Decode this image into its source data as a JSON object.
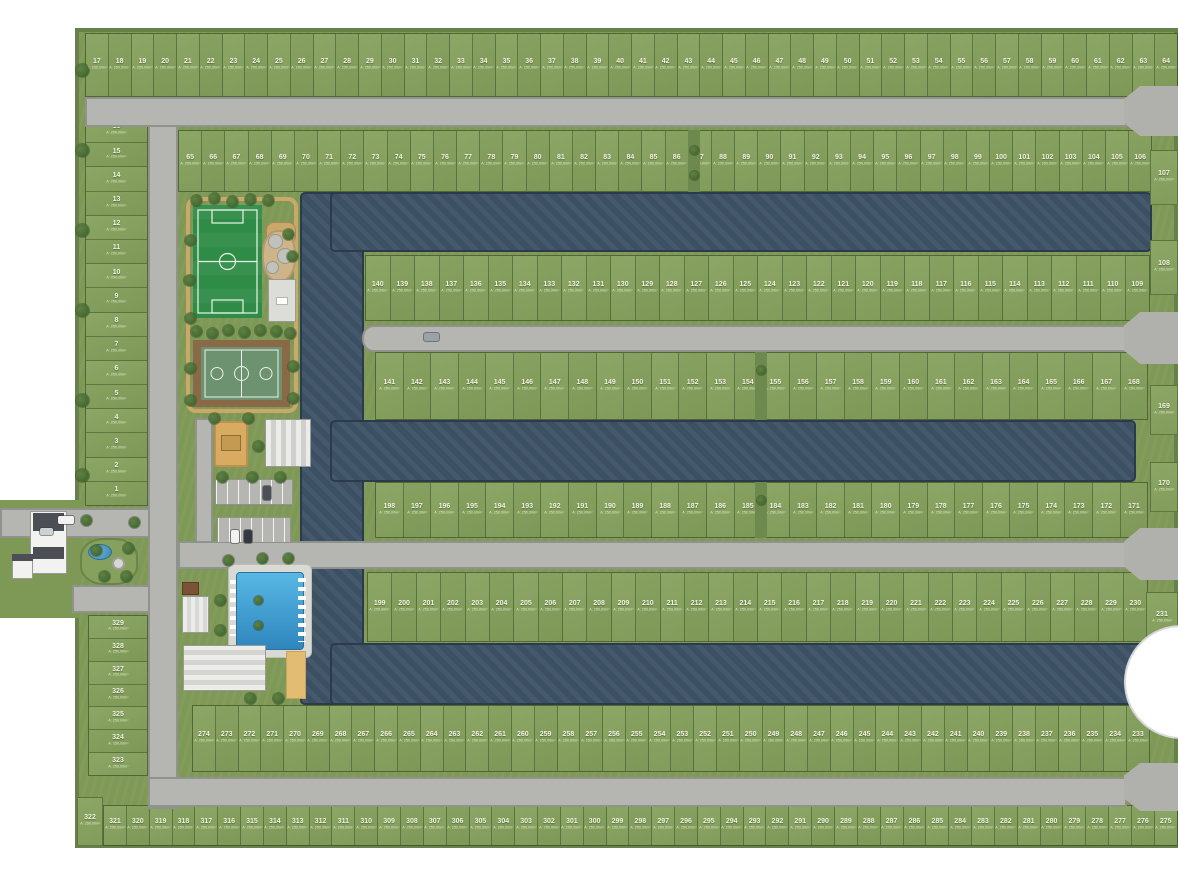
{
  "map_type": "residential-masterplan-site-map",
  "area_label": "A: 250,00m²",
  "colors": {
    "grass": "#7e9856",
    "lot_green": "#8ca765",
    "road_gray": "#b5b6b2",
    "water_blue": "#3c5064",
    "pool_blue": "#3f9fd1",
    "sand_tan": "#d8ab60",
    "soccer_field_green": "#2f8c46",
    "court_green": "#6d9270",
    "path_tan": "#c9a86a",
    "building_white": "#ececea",
    "roof_dark": "#4b4f55"
  },
  "lot_rows": [
    {
      "id": "left-column-top",
      "dir": "v",
      "rect": [
        85,
        118,
        63,
        388
      ],
      "from": 16,
      "to": 1
    },
    {
      "id": "top-row",
      "dir": "h",
      "rect": [
        85,
        33,
        1093,
        64
      ],
      "from": 17,
      "to": 64
    },
    {
      "id": "row-65-106",
      "dir": "h",
      "rect": [
        178,
        130,
        974,
        62
      ],
      "from": 65,
      "to": 106
    },
    {
      "id": "row-140-109",
      "dir": "h",
      "rect": [
        365,
        255,
        785,
        66
      ],
      "from": 140,
      "to": 109
    },
    {
      "id": "row-141-168",
      "dir": "h",
      "rect": [
        375,
        352,
        773,
        68
      ],
      "from": 141,
      "to": 168
    },
    {
      "id": "row-198-171",
      "dir": "h",
      "rect": [
        375,
        482,
        773,
        56
      ],
      "from": 198,
      "to": 171
    },
    {
      "id": "row-199-230",
      "dir": "h",
      "rect": [
        367,
        572,
        781,
        70
      ],
      "from": 199,
      "to": 230
    },
    {
      "id": "row-274-233",
      "dir": "h",
      "rect": [
        192,
        705,
        958,
        67
      ],
      "from": 274,
      "to": 233
    },
    {
      "id": "bottom-row",
      "dir": "h",
      "rect": [
        103,
        805,
        1075,
        41
      ],
      "from": 321,
      "to": 275
    },
    {
      "id": "left-column-bottom",
      "dir": "v",
      "rect": [
        88,
        615,
        60,
        161
      ],
      "from": 329,
      "to": 323
    }
  ],
  "edge_lots": [
    {
      "num": "107",
      "rect": [
        1150,
        150,
        28,
        55
      ]
    },
    {
      "num": "108",
      "rect": [
        1150,
        240,
        28,
        55
      ]
    },
    {
      "num": "169",
      "rect": [
        1150,
        385,
        28,
        50
      ]
    },
    {
      "num": "170",
      "rect": [
        1150,
        462,
        28,
        50
      ]
    },
    {
      "num": "231",
      "rect": [
        1146,
        592,
        32,
        52
      ]
    },
    {
      "num": "322",
      "rect": [
        77,
        797,
        26,
        49
      ]
    }
  ],
  "roads": [
    {
      "id": "left-vertical-road",
      "rect": [
        148,
        97,
        30,
        712
      ]
    },
    {
      "id": "top-road",
      "rect": [
        85,
        97,
        1042,
        30
      ]
    },
    {
      "id": "street-2",
      "rect": [
        362,
        325,
        765,
        27
      ],
      "cap": "left"
    },
    {
      "id": "street-3",
      "rect": [
        178,
        541,
        949,
        28
      ]
    },
    {
      "id": "bottom-road",
      "rect": [
        148,
        777,
        979,
        30
      ]
    },
    {
      "id": "entrance-road-in",
      "rect": [
        0,
        508,
        150,
        30
      ]
    },
    {
      "id": "entrance-road-out",
      "rect": [
        72,
        585,
        78,
        28
      ]
    },
    {
      "id": "amenity-lane",
      "rect": [
        195,
        418,
        18,
        125
      ]
    }
  ],
  "culdesacs": [
    {
      "rect": [
        1124,
        86,
        54,
        50
      ]
    },
    {
      "rect": [
        1124,
        312,
        54,
        52
      ]
    },
    {
      "rect": [
        1124,
        528,
        54,
        52
      ]
    },
    {
      "rect": [
        1124,
        763,
        54,
        48
      ]
    }
  ],
  "water": [
    {
      "id": "canal-spine",
      "rect": [
        300,
        192,
        64,
        513
      ]
    },
    {
      "id": "canal-north",
      "rect": [
        330,
        192,
        822,
        60
      ]
    },
    {
      "id": "canal-middle",
      "rect": [
        330,
        420,
        806,
        62
      ]
    },
    {
      "id": "canal-south",
      "rect": [
        330,
        643,
        820,
        62
      ]
    }
  ],
  "dividers": [
    [
      688,
      130,
      12,
      62
    ],
    [
      755,
      352,
      12,
      68
    ],
    [
      755,
      482,
      12,
      56
    ]
  ],
  "decor": {
    "trees": [
      [
        82,
        70,
        13
      ],
      [
        82,
        150,
        13
      ],
      [
        82,
        230,
        13
      ],
      [
        82,
        310,
        13
      ],
      [
        82,
        400,
        13
      ],
      [
        82,
        475,
        13
      ],
      [
        196,
        200
      ],
      [
        214,
        198
      ],
      [
        232,
        201
      ],
      [
        250,
        199
      ],
      [
        268,
        200
      ],
      [
        288,
        234
      ],
      [
        292,
        256
      ],
      [
        190,
        240
      ],
      [
        189,
        280
      ],
      [
        190,
        318
      ],
      [
        196,
        331
      ],
      [
        212,
        333
      ],
      [
        228,
        330
      ],
      [
        244,
        332
      ],
      [
        260,
        330
      ],
      [
        276,
        331
      ],
      [
        290,
        333
      ],
      [
        190,
        368
      ],
      [
        190,
        400
      ],
      [
        293,
        366
      ],
      [
        293,
        398
      ],
      [
        214,
        418
      ],
      [
        248,
        418
      ],
      [
        258,
        446
      ],
      [
        222,
        477
      ],
      [
        252,
        477
      ],
      [
        280,
        477
      ],
      [
        228,
        560
      ],
      [
        262,
        558
      ],
      [
        288,
        558
      ],
      [
        220,
        600
      ],
      [
        220,
        630
      ],
      [
        258,
        600,
        9
      ],
      [
        258,
        625,
        9
      ],
      [
        250,
        698
      ],
      [
        278,
        698
      ],
      [
        96,
        550
      ],
      [
        128,
        548
      ],
      [
        104,
        576
      ],
      [
        126,
        576
      ],
      [
        86,
        520
      ],
      [
        134,
        522
      ],
      [
        694,
        150,
        9
      ],
      [
        694,
        175,
        9
      ],
      [
        761,
        370,
        9
      ],
      [
        761,
        500,
        9
      ]
    ],
    "cars": [
      {
        "rect": [
          58,
          516,
          16,
          8
        ],
        "color": "#f2f2f2"
      },
      {
        "rect": [
          40,
          528,
          13,
          7
        ],
        "color": "#ccd1d6"
      },
      {
        "rect": [
          231,
          530,
          8,
          13
        ],
        "color": "#f2f2f2"
      },
      {
        "rect": [
          244,
          530,
          8,
          13
        ],
        "color": "#343941"
      },
      {
        "rect": [
          263,
          486,
          8,
          14
        ],
        "color": "#4a5058"
      },
      {
        "rect": [
          424,
          333,
          15,
          8
        ],
        "color": "#9aa1a8"
      }
    ]
  }
}
